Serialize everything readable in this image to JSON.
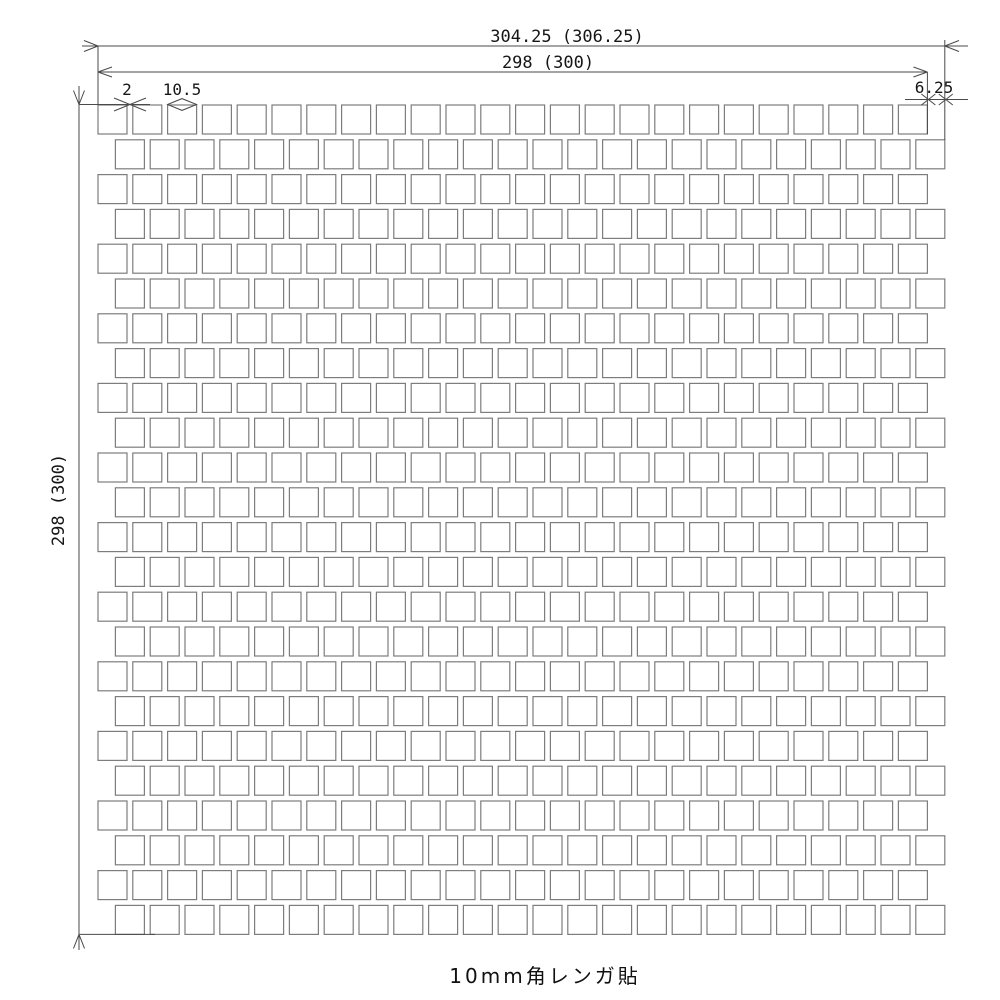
{
  "drawing": {
    "caption": "10mm角レンガ貼",
    "dimensions": {
      "overall_width": "304.25 (306.25)",
      "tiled_width": "298 (300)",
      "tiled_height": "298 (300)",
      "joint_width": "2",
      "tile_pitch": "10.5",
      "row_offset": "6.25"
    },
    "grid": {
      "rows": 24,
      "cols": 24,
      "tile_size": 29,
      "gap": 5.8,
      "x0": 98,
      "y0": 105,
      "even_row_offset": 17.4
    },
    "colors": {
      "tile_border": "#7d7d7d",
      "dimension_line": "#4a4a4a",
      "text": "#161616",
      "background": "#ffffff"
    }
  }
}
